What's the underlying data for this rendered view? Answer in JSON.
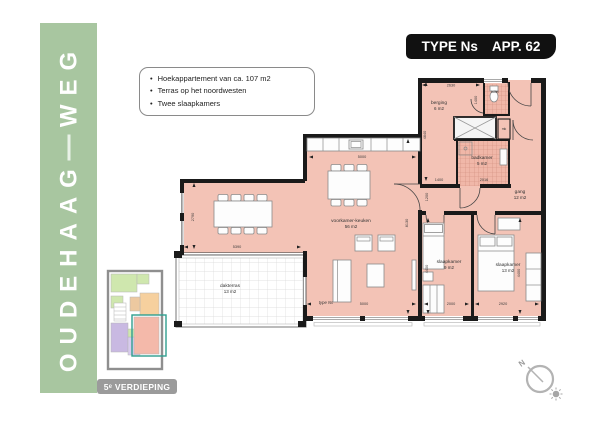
{
  "colors": {
    "banner_green": "#a8c6a0",
    "room_pink": "#f3c3b6",
    "tile_line": "#cf8d7c",
    "wall_black": "#1a1a1a",
    "title_badge_black": "#111111",
    "floor_badge_gray": "#9b9b9b",
    "mini_green": "#cfe7ae",
    "mini_orange": "#f6d09e",
    "mini_purple": "#c9b9e2",
    "mini_pink": "#f4b9aa",
    "mini_highlight_teal": "#2f9e8f"
  },
  "banner": {
    "name_part1": "OUDEHAAG",
    "name_part2": "WEG"
  },
  "title_badge": {
    "type": "TYPE Ns",
    "app": "APP. 62"
  },
  "info_box": {
    "bullet_char": "•",
    "bullets": [
      "Hoekappartement van ca. 107 m2",
      "Terras op het noordwesten",
      "Twee slaapkamers"
    ]
  },
  "floorplan": {
    "type_label": "type Ns",
    "rooms": [
      {
        "name": "voorkamer-keuken",
        "area": "56 m2"
      },
      {
        "name": "berging",
        "area": "6 m2"
      },
      {
        "name": "toilet",
        "area": ""
      },
      {
        "name": "badkamer",
        "area": "5 m2"
      },
      {
        "name": "gang",
        "area": "12 m2"
      },
      {
        "name": "slaapkamer",
        "area": "9 m2"
      },
      {
        "name": "slaapkamer",
        "area": "13 m2"
      },
      {
        "name": "dakterras",
        "area": "13 m2"
      },
      {
        "name": "mk",
        "area": ""
      }
    ],
    "dimensions": {
      "berging_width": "2630",
      "berging_height": "4640",
      "toilet_height": "1400",
      "kitchen_width": "5000",
      "wing_height": "2790",
      "wing_width": "5390",
      "living_height": "8130",
      "gang_opening": "1200",
      "badkamer_height": "1400",
      "badkamer_width": "2016",
      "bedroom1_height": "4400",
      "bedroom1_width": "2000",
      "bedroom2_height": "4400",
      "bedroom2_width": "2920",
      "living_width": "5000"
    }
  },
  "mini_plan": {
    "floor_label": "5ᵉ VERDIEPING"
  },
  "compass": {
    "north_label": "N"
  }
}
